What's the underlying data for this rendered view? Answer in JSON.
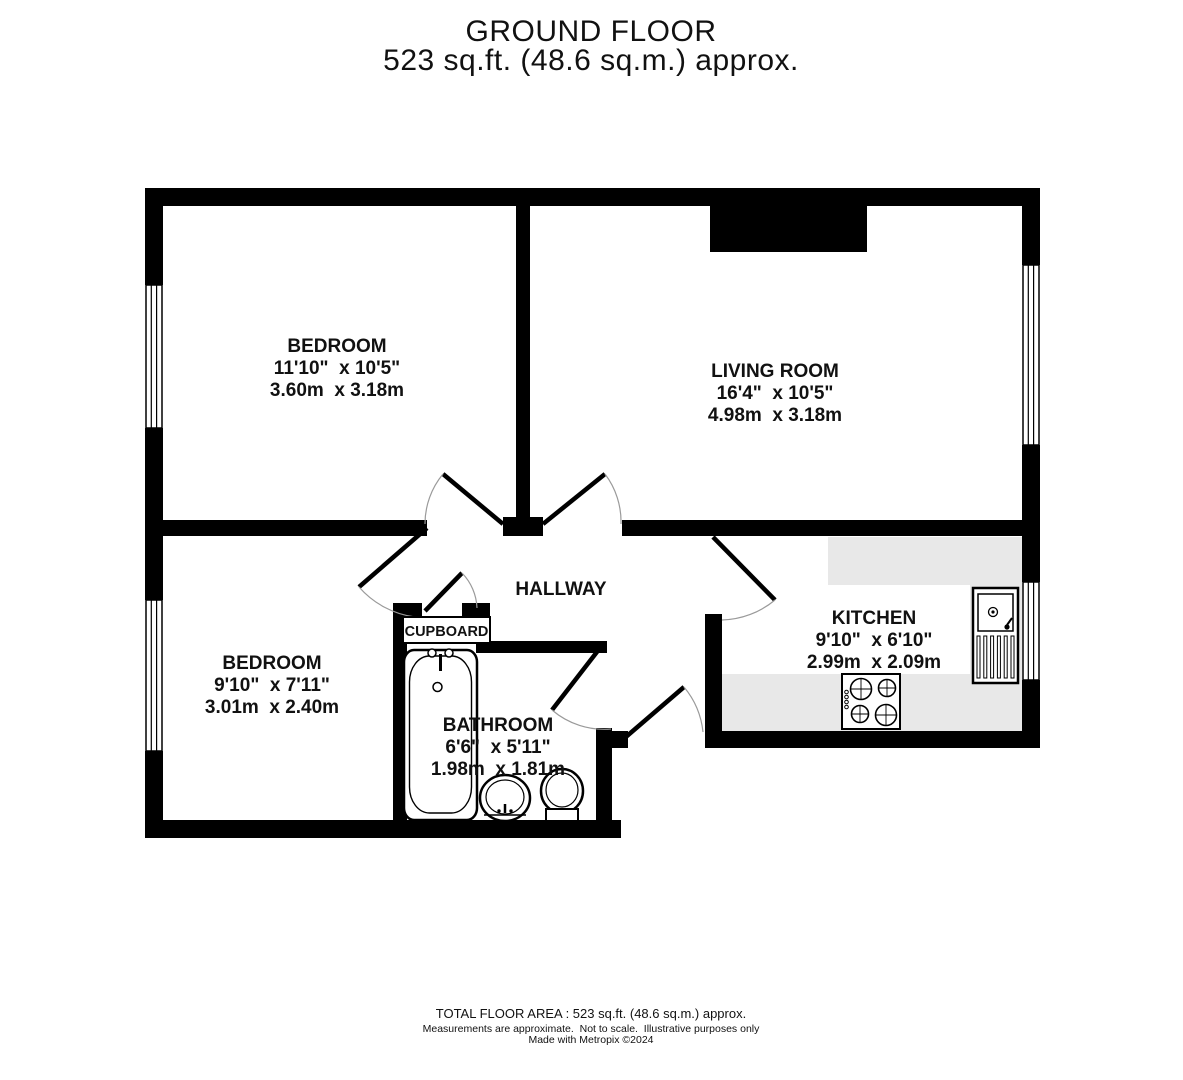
{
  "title": {
    "line1": "GROUND FLOOR",
    "line2": "523 sq.ft. (48.6 sq.m.) approx."
  },
  "rooms": {
    "bedroom1": {
      "name": "BEDROOM",
      "imperial": "11'10\"  x 10'5\"",
      "metric": "3.60m  x 3.18m"
    },
    "living": {
      "name": "LIVING ROOM",
      "imperial": "16'4\"  x 10'5\"",
      "metric": "4.98m  x 3.18m"
    },
    "bedroom2": {
      "name": "BEDROOM",
      "imperial": "9'10\"  x 7'11\"",
      "metric": "3.01m  x 2.40m"
    },
    "hallway": {
      "name": "HALLWAY"
    },
    "cupboard": {
      "name": "CUPBOARD"
    },
    "bathroom": {
      "name": "BATHROOM",
      "imperial": "6'6\"  x 5'11\"",
      "metric": "1.98m  x 1.81m"
    },
    "kitchen": {
      "name": "KITCHEN",
      "imperial": "9'10\"  x 6'10\"",
      "metric": "2.99m  x 2.09m"
    }
  },
  "footer": {
    "line1": "TOTAL FLOOR AREA : 523 sq.ft. (48.6 sq.m.) approx.",
    "line2": "Measurements are approximate.  Not to scale.  Illustrative purposes only",
    "line3": "Made with Metropix ©2024"
  },
  "colors": {
    "wall": "#000000",
    "counter": "#e8e8e8",
    "background": "#ffffff"
  }
}
